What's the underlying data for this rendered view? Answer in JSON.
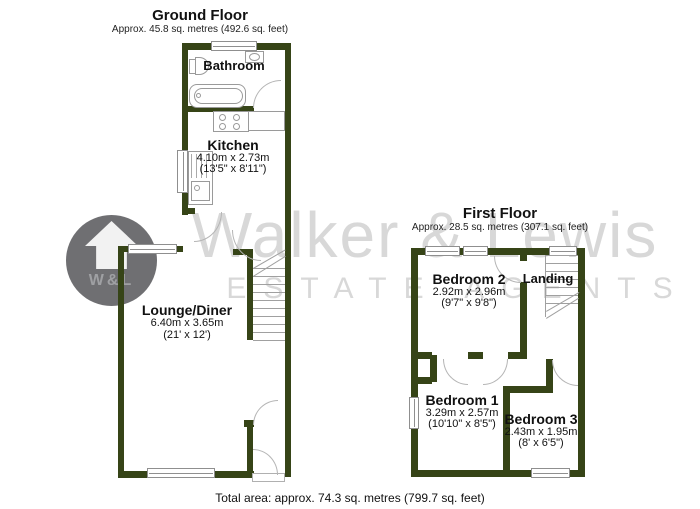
{
  "watermark": {
    "brand": "Walker & Lewis",
    "tagline": "ESTATE AGENTS",
    "monogram": "W&L"
  },
  "ground_floor": {
    "title": "Ground Floor",
    "area": "Approx. 45.8 sq. metres (492.6 sq. feet)",
    "rooms": {
      "bathroom": {
        "name": "Bathroom"
      },
      "kitchen": {
        "name": "Kitchen",
        "metric": "4.10m x 2.73m",
        "imperial": "(13'5\" x 8'11\")"
      },
      "lounge_diner": {
        "name": "Lounge/Diner",
        "metric": "6.40m x 3.65m",
        "imperial": "(21' x 12')"
      }
    }
  },
  "first_floor": {
    "title": "First Floor",
    "area": "Approx. 28.5 sq. metres (307.1 sq. feet)",
    "rooms": {
      "bedroom_2": {
        "name": "Bedroom 2",
        "metric": "2.92m x 2.96m",
        "imperial": "(9'7\" x 9'8\")"
      },
      "landing": {
        "name": "Landing"
      },
      "bedroom_1": {
        "name": "Bedroom 1",
        "metric": "3.29m x 2.57m",
        "imperial": "(10'10\" x 8'5\")"
      },
      "bedroom_3": {
        "name": "Bedroom 3",
        "metric": "2.43m x 1.95m",
        "imperial": "(8' x 6'5\")"
      }
    }
  },
  "footer": {
    "total_area": "Total area: approx. 74.3 sq. metres (799.7 sq. feet)"
  },
  "colors": {
    "wall": "#364417",
    "fixture_outline": "#9a9a9a",
    "watermark_text": "#d8d8d8",
    "logo_circle": "#6f6f72"
  }
}
